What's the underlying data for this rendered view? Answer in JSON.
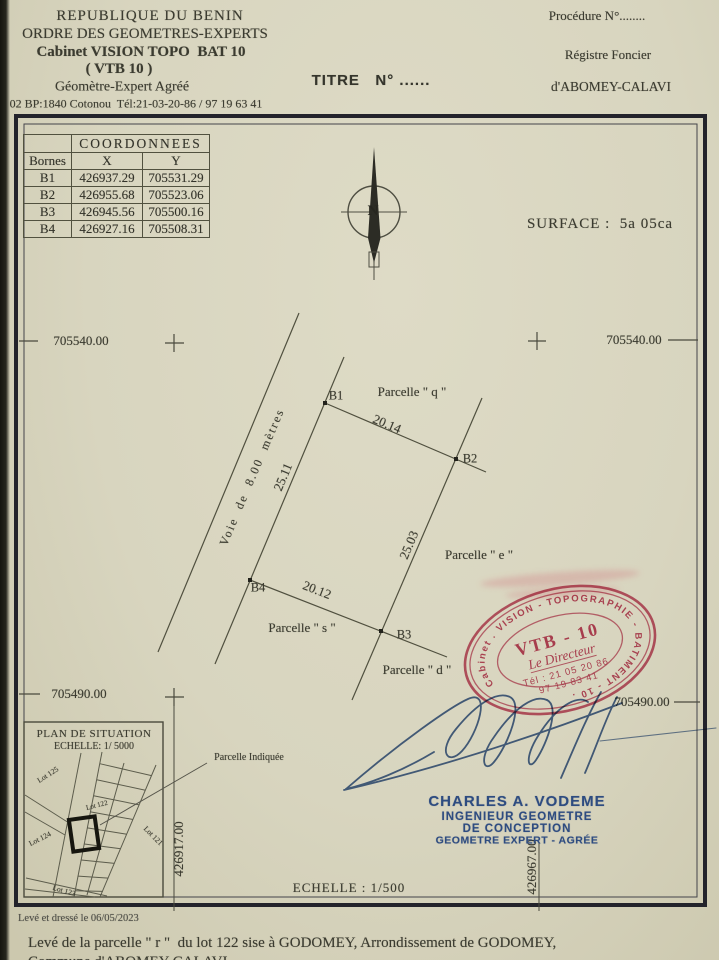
{
  "header": {
    "line1": "REPUBLIQUE DU BENIN",
    "line2": "ORDRE DES GEOMETRES-EXPERTS",
    "line3": "Cabinet VISION TOPO  BAT 10",
    "line4": "( VTB 10 )",
    "line5": "Géomètre-Expert Agréé",
    "line6": "02 BP:1840 Cotonou  Tél:21-03-20-86 / 97 19 63 41"
  },
  "title_block": {
    "titre": "TITRE   N° ......",
    "procedure": "Procédure N°........",
    "registre1": "Régistre Foncier",
    "registre2": "d'ABOMEY-CALAVI"
  },
  "coords_table": {
    "title": "COORDONNEES",
    "col_bornes": "Bornes",
    "col_x": "X",
    "col_y": "Y",
    "rows": [
      {
        "b": "B1",
        "x": "426937.29",
        "y": "705531.29"
      },
      {
        "b": "B2",
        "x": "426955.68",
        "y": "705523.06"
      },
      {
        "b": "B3",
        "x": "426945.56",
        "y": "705500.16"
      },
      {
        "b": "B4",
        "x": "426927.16",
        "y": "705508.31"
      }
    ]
  },
  "surface_label": "SURFACE :  5a 05ca",
  "compass_n": "N",
  "grid": {
    "north_top": "705540.00",
    "north_bottom": "705490.00",
    "east_left": "426917.00",
    "east_right": "426967.00"
  },
  "plot": {
    "b1": "B1",
    "b2": "B2",
    "b3": "B3",
    "b4": "B4",
    "len_b1b2": "20.14",
    "len_b1b4": "25.11",
    "len_b2b3": "25.03",
    "len_b4b3": "20.12",
    "road": "Voie  de  8.00  mètres",
    "parcel_q": "Parcelle \" q \"",
    "parcel_e": "Parcelle \" e \"",
    "parcel_s": "Parcelle \" s \"",
    "parcel_d": "Parcelle \" d \""
  },
  "stamp": {
    "ring": "Cabinet . VISION - TOPOGRAPHIE - BATIMENT - 10 .",
    "line1": "VTB - 10",
    "line2": "Le Directeur",
    "line3": "Tél : 21 05 20 86",
    "line4": "97 19 83 41",
    "color": "#c23f5e"
  },
  "signatory": {
    "name": "CHARLES A. VODEME",
    "role1": "INGENIEUR GEOMETRE",
    "role2": "DE CONCEPTION",
    "role3": "GEOMETRE EXPERT - AGRÉE"
  },
  "scale_main": "ECHELLE : 1/500",
  "inset": {
    "title1": "PLAN DE SITUATION",
    "title2": "ECHELLE: 1/ 5000",
    "pointer": "Parcelle Indiquée",
    "lot125": "Lot 125",
    "lot124": "Lot 124",
    "lot122": "Lot 122",
    "lot121": "Lot 121",
    "lot123": "Lot 123"
  },
  "footer": {
    "drafted": "Levé et dressé le 06/05/2023",
    "line1": "Levé de la parcelle \" r \"  du lot 122 sise à GODOMEY, Arrondissement de GODOMEY,",
    "line2": "Commune d'ABOMEY-CALAVI"
  }
}
